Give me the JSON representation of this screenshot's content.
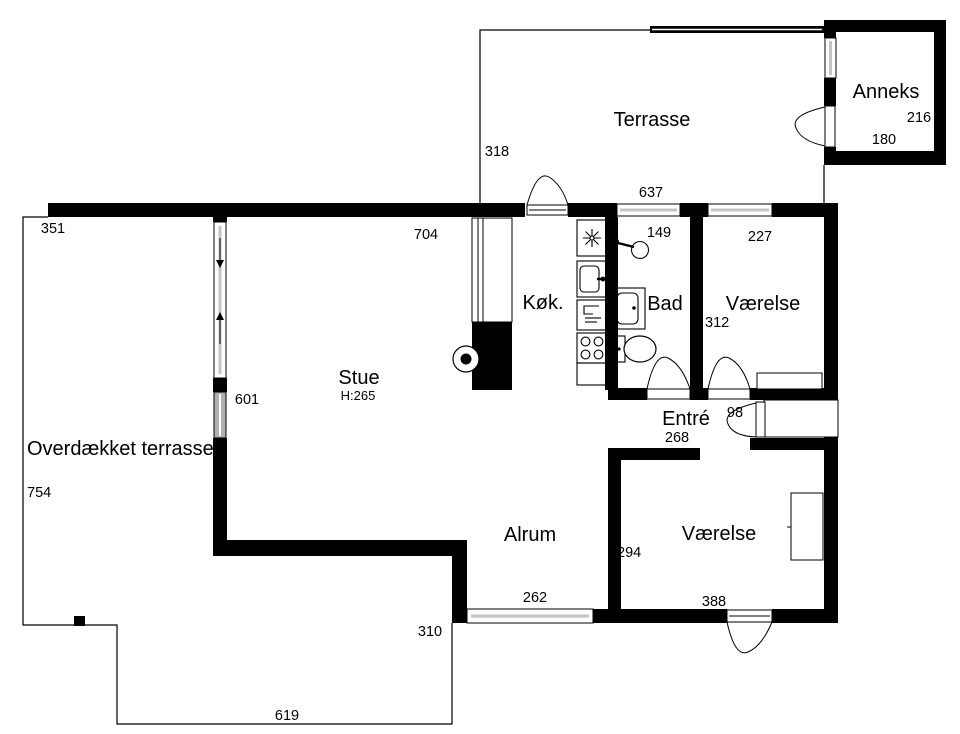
{
  "document": {
    "type": "floor-plan",
    "language": "da"
  },
  "labels": {
    "terrasse": "Terrasse",
    "anneks": "Anneks",
    "kok": "Køk.",
    "bad": "Bad",
    "vaerelse_nord": "Værelse",
    "stue": "Stue",
    "stue_height": "H:265",
    "entre": "Entré",
    "alrum": "Alrum",
    "vaerelse_syd": "Værelse",
    "overdaekket": "Overdækket terrasse"
  },
  "dimensions": {
    "terrasse_height": "318",
    "terrasse_width": "637",
    "anneks_height": "216",
    "anneks_width": "180",
    "covered_width": "351",
    "stue_width": "704",
    "bad_width": "149",
    "vaerelse_nord_width": "227",
    "vaerelse_nord_height": "312",
    "stue_window": "601",
    "entre_door": "98",
    "entre_width": "268",
    "covered_height": "754",
    "alrum_height": "294",
    "alrum_window": "262",
    "vaerelse_syd_width": "388",
    "alrum_step": "310",
    "covered_bottom": "619"
  },
  "colors": {
    "wall": "#000000",
    "bg": "#ffffff",
    "glass": "#c4c4c4",
    "slide": "#b0b0b0"
  }
}
